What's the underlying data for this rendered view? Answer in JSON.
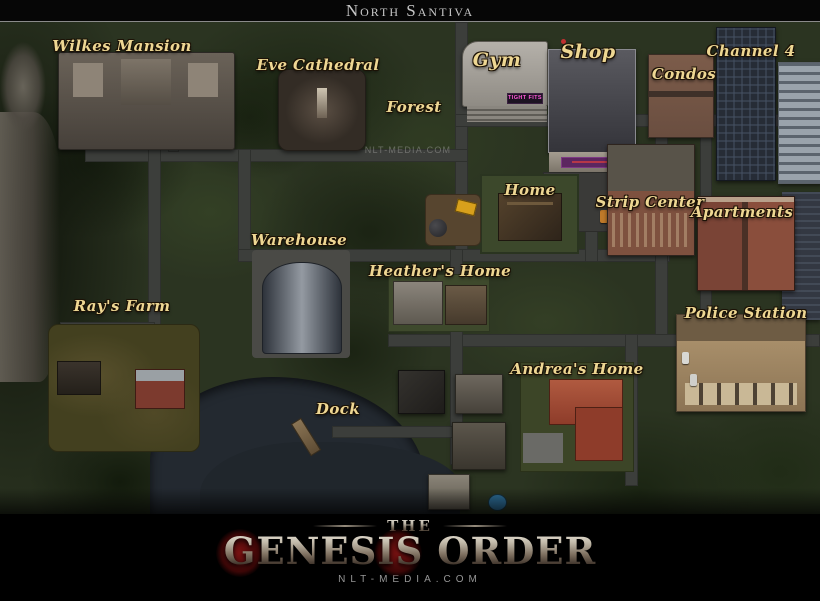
{
  "title_bar": {
    "title": "North Santiva"
  },
  "map": {
    "name": "North Santiva overview map",
    "watermark": {
      "text": "nlt-media.com",
      "x": 408,
      "y": 128
    },
    "locations": [
      {
        "id": "wilkes-mansion",
        "label": "Wilkes Mansion",
        "x": 122,
        "y": 24
      },
      {
        "id": "eve-cathedral",
        "label": "Eve Cathedral",
        "x": 318,
        "y": 43
      },
      {
        "id": "forest",
        "label": "Forest",
        "x": 414,
        "y": 85
      },
      {
        "id": "gym",
        "label": "Gym",
        "x": 497,
        "y": 38
      },
      {
        "id": "shop",
        "label": "Shop",
        "x": 588,
        "y": 30
      },
      {
        "id": "channel-4",
        "label": "Channel 4",
        "x": 751,
        "y": 29
      },
      {
        "id": "condos",
        "label": "Condos",
        "x": 684,
        "y": 52
      },
      {
        "id": "home",
        "label": "Home",
        "x": 530,
        "y": 168
      },
      {
        "id": "strip-center",
        "label": "Strip Center",
        "x": 650,
        "y": 180
      },
      {
        "id": "apartments",
        "label": "Apartments",
        "x": 742,
        "y": 190
      },
      {
        "id": "warehouse",
        "label": "Warehouse",
        "x": 299,
        "y": 218
      },
      {
        "id": "heathers-home",
        "label": "Heather's Home",
        "x": 440,
        "y": 249
      },
      {
        "id": "rays-farm",
        "label": "Ray's Farm",
        "x": 122,
        "y": 284
      },
      {
        "id": "police-station",
        "label": "Police Station",
        "x": 746,
        "y": 291
      },
      {
        "id": "andreas-home",
        "label": "Andrea's Home",
        "x": 577,
        "y": 347
      },
      {
        "id": "dock",
        "label": "Dock",
        "x": 338,
        "y": 387
      }
    ],
    "signs": [
      {
        "id": "gym-sign",
        "text": "TIGHT FITS",
        "color": "#ff58da"
      }
    ]
  },
  "footer": {
    "logo_top": "The",
    "logo_main": "Genesis Order",
    "website": "nlt-media.com"
  },
  "colors": {
    "label_gold": "#eed793",
    "title_silver": "#c6c6c6",
    "gym_sign_pink": "#ff58da",
    "logo_red": "#7a1212"
  }
}
